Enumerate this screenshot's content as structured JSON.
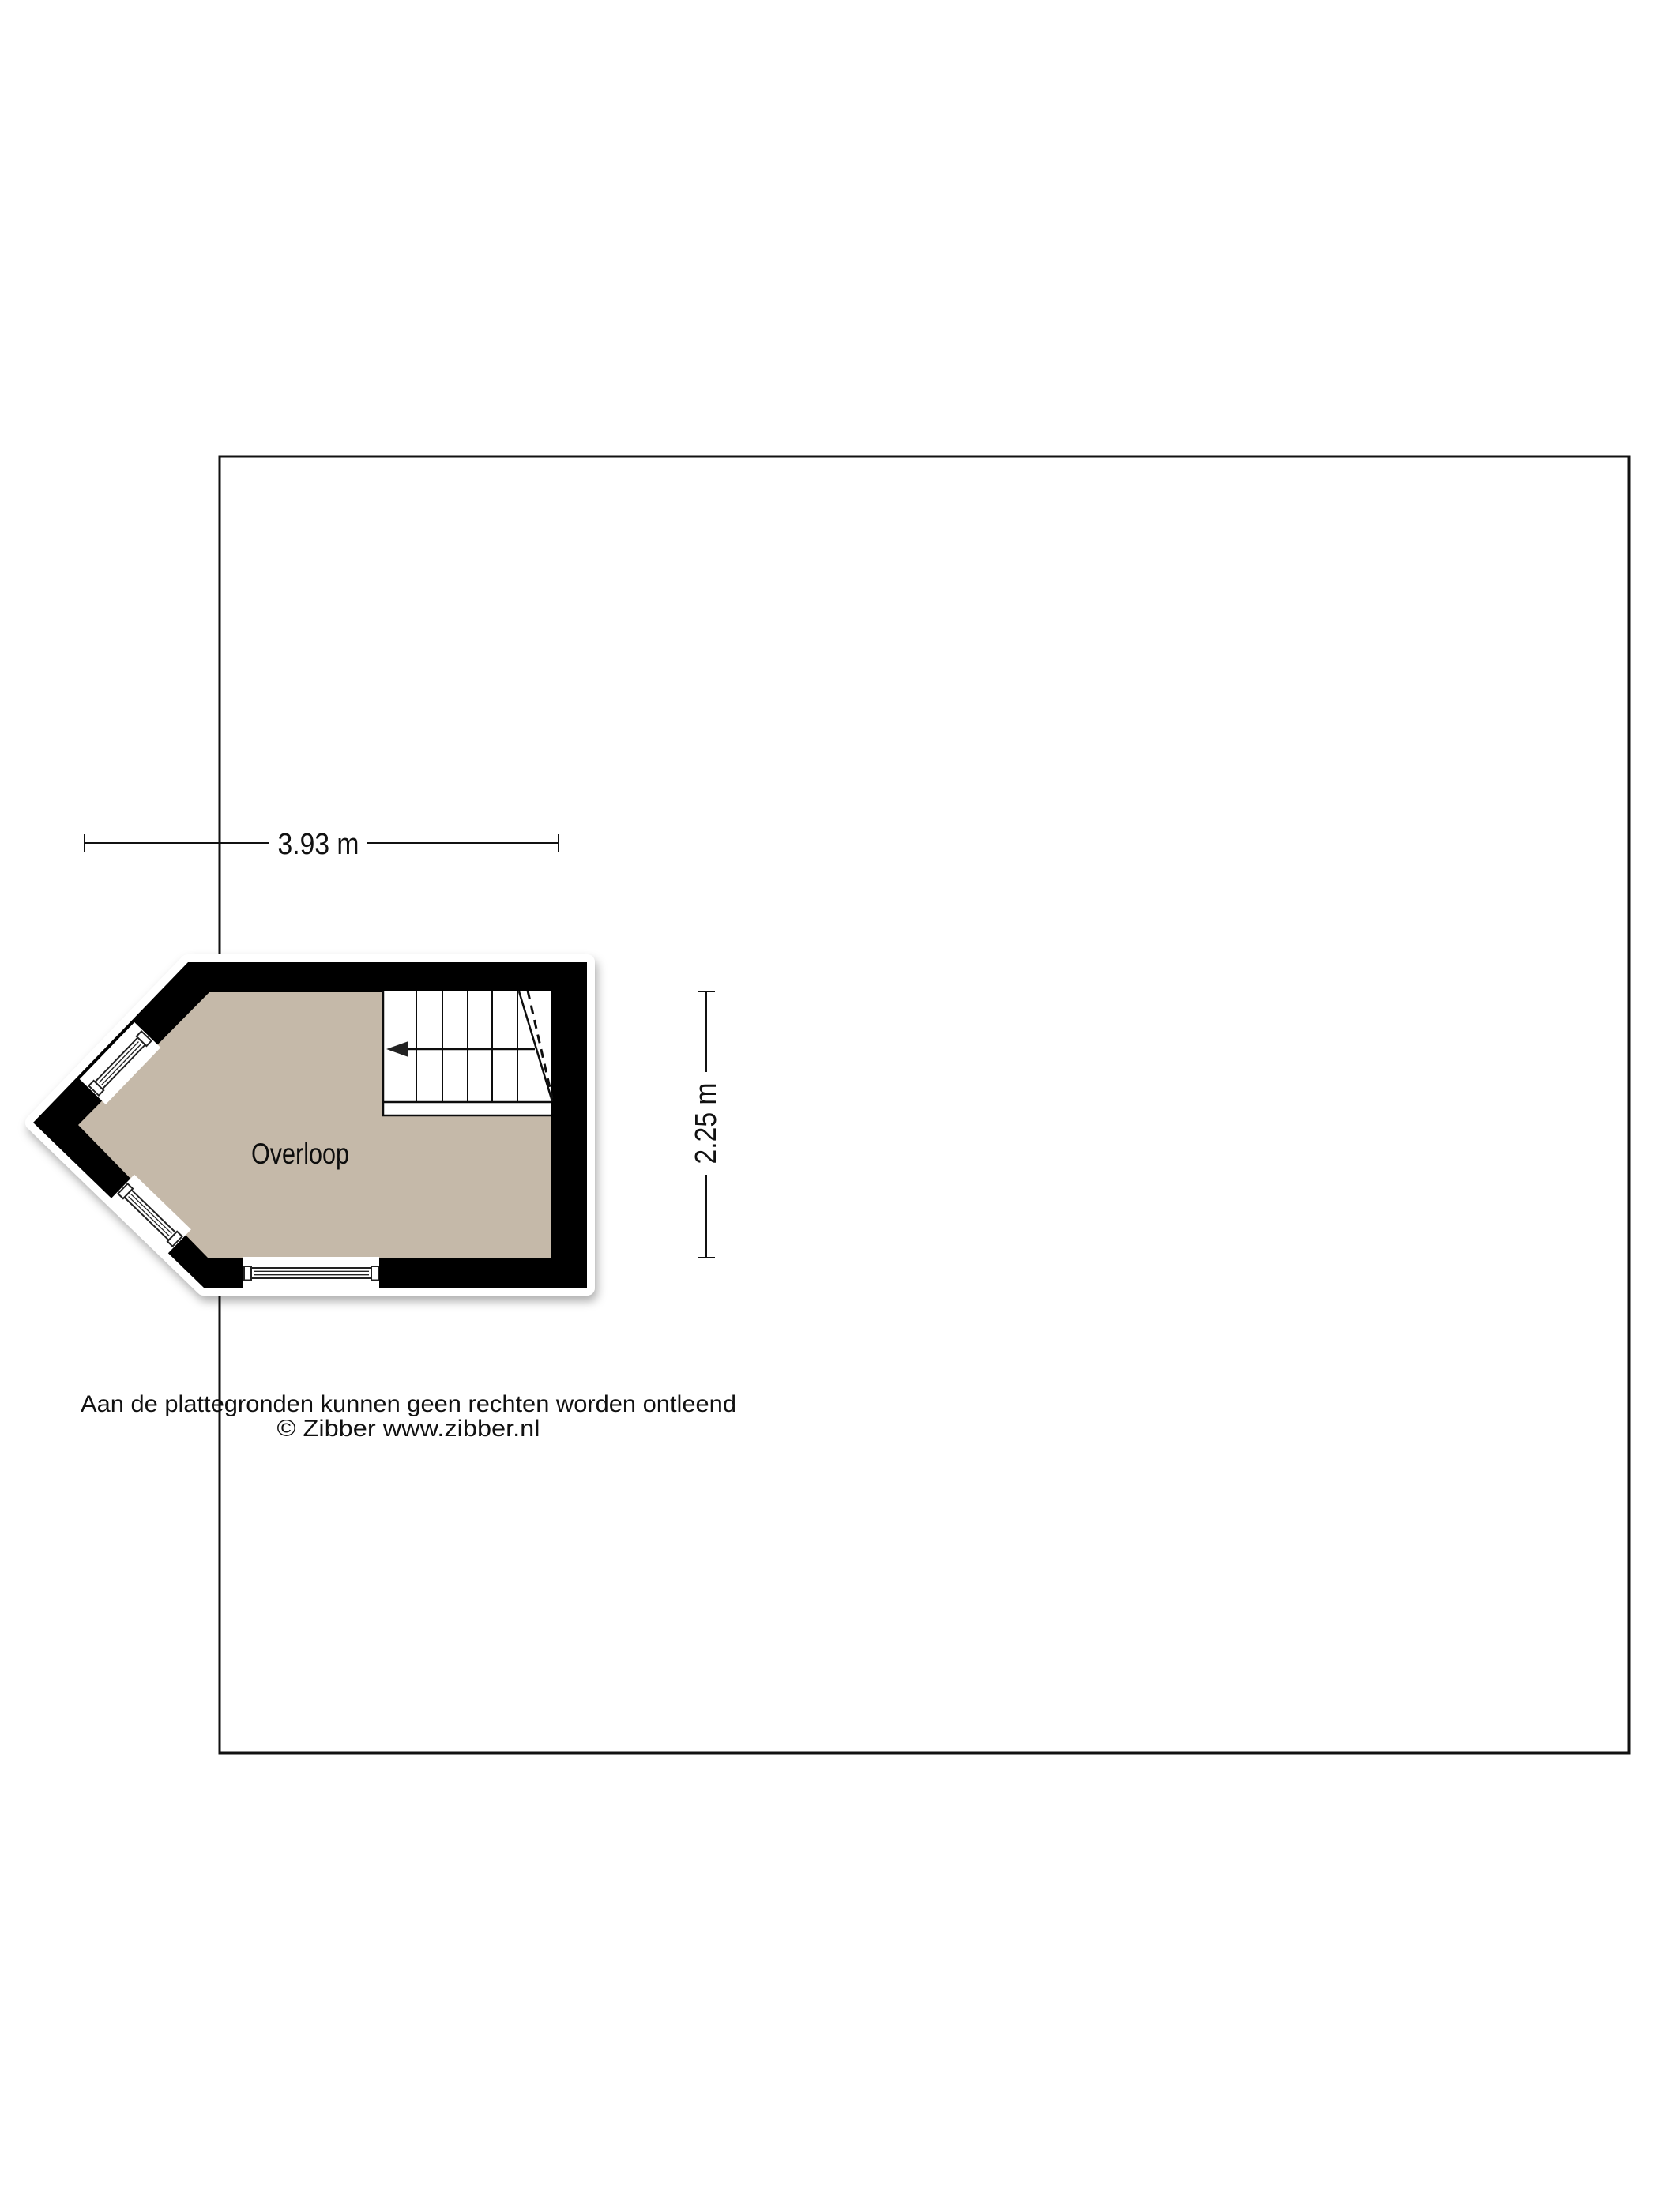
{
  "page": {
    "background": "#ffffff"
  },
  "border": {
    "color": "#111111"
  },
  "plan": {
    "room_label": "Overloop",
    "floor_color": "#c5b9a9",
    "wall_color": "#000000"
  },
  "dimensions": {
    "width_label": "3.93 m",
    "height_label": "2.25 m"
  },
  "stairs": {
    "direction_icon": "left-arrow"
  },
  "footer": {
    "disclaimer": "Aan de plattegronden kunnen geen rechten worden ontleend",
    "copyright": "© Zibber www.zibber.nl"
  }
}
